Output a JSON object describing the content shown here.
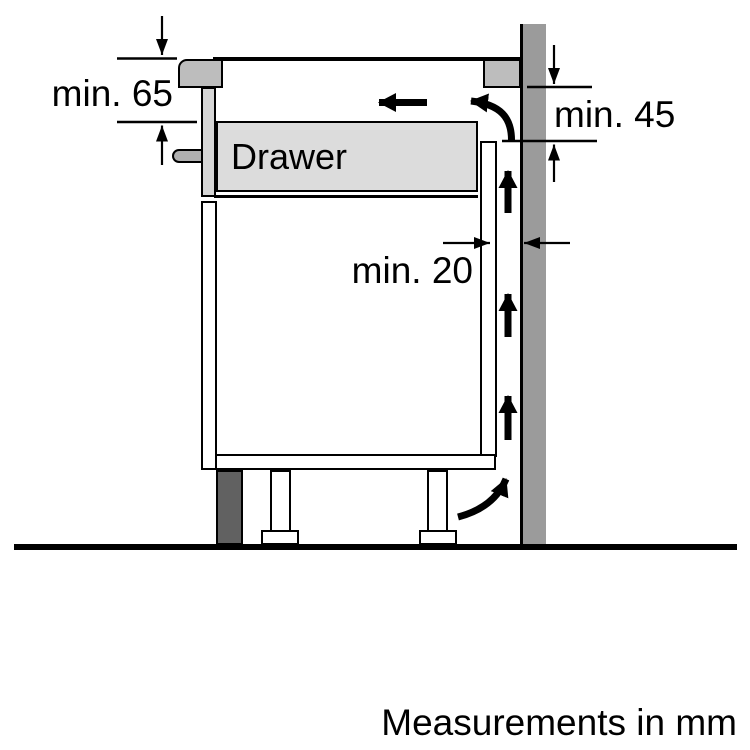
{
  "labels": {
    "dim_worktop_to_drawer": "min. 65",
    "dim_outlet_height": "min. 45",
    "dim_wall_gap": "min. 20",
    "drawer": "Drawer",
    "units_note": "Measurements in mm"
  },
  "colors": {
    "wall": "#9b9b9b",
    "worktop-section": "#bdbdbd",
    "drawer-fill": "#dcdcdc",
    "drawer-front": "#d6d6d6",
    "handle": "#b0b0b0",
    "plinth": "#616161",
    "line": "#000000"
  }
}
